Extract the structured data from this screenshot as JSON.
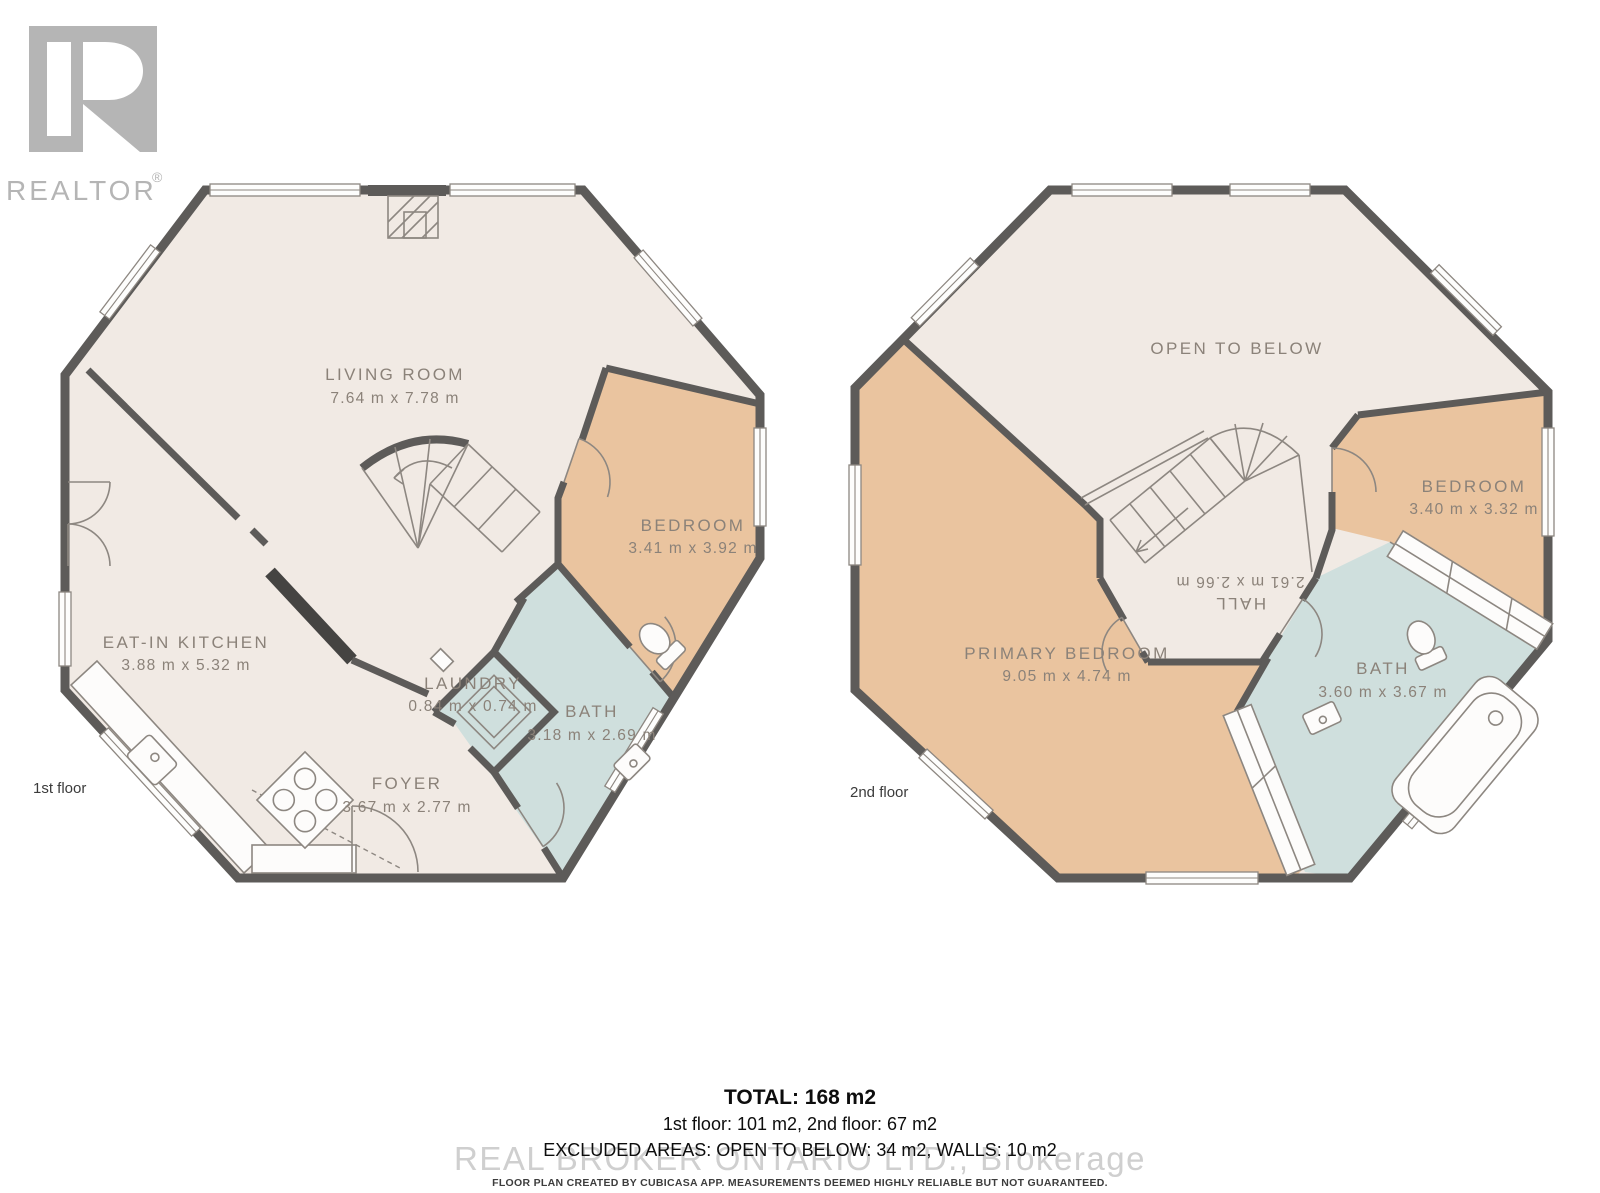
{
  "logo": {
    "brand": "REALTOR",
    "registered": "®"
  },
  "floors": [
    {
      "label": "1st floor",
      "rooms": [
        {
          "name": "LIVING ROOM",
          "dims": "7.64 m x 7.78 m"
        },
        {
          "name": "BEDROOM",
          "dims": "3.41 m x 3.92 m"
        },
        {
          "name": "EAT-IN KITCHEN",
          "dims": "3.88 m x 5.32 m"
        },
        {
          "name": "LAUNDRY",
          "dims": "0.84 m x 0.74 m"
        },
        {
          "name": "BATH",
          "dims": "3.18 m x 2.69 m"
        },
        {
          "name": "FOYER",
          "dims": "3.67 m x 2.77 m"
        }
      ]
    },
    {
      "label": "2nd floor",
      "rooms": [
        {
          "name": "OPEN TO BELOW",
          "dims": ""
        },
        {
          "name": "BEDROOM",
          "dims": "3.40 m x 3.32 m"
        },
        {
          "name": "PRIMARY BEDROOM",
          "dims": "9.05 m x 4.74 m"
        },
        {
          "name": "HALL",
          "dims": "2.61 m x 2.66 m"
        },
        {
          "name": "BATH",
          "dims": "3.60 m x 3.67 m"
        }
      ]
    }
  ],
  "summary": {
    "total": "TOTAL: 168 m2",
    "floors": "1st floor: 101 m2, 2nd floor: 67 m2",
    "excluded": "EXCLUDED AREAS: OPEN TO BELOW: 34 m2, WALLS: 10 m2",
    "watermark": "REAL BROKER ONTARIO LTD., Brokerage",
    "disclaimer": "FLOOR PLAN CREATED BY CUBICASA APP. MEASUREMENTS DEEMED HIGHLY RELIABLE BUT NOT GUARANTEED."
  },
  "colors": {
    "wall": "#5d5b59",
    "floor": "#f1eae4",
    "bedroom": "#eac49f",
    "bath": "#cfdfdd",
    "line": "#8d8781",
    "label": "#8b8279"
  }
}
